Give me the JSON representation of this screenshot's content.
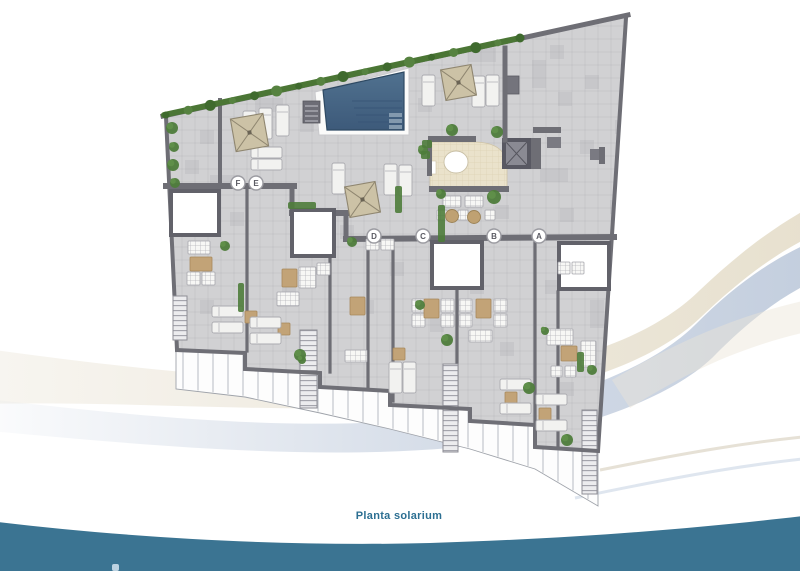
{
  "title": "Planta solarium",
  "caption": {
    "text": "Planta solarium"
  },
  "plan": {
    "type": "floorplan",
    "unit_labels": [
      "F",
      "E",
      "D",
      "C",
      "B",
      "A"
    ],
    "colors": {
      "floor": "#d1d1d3",
      "unit_floor": "#d6d5d3",
      "wall": "#6e6e75",
      "wall_dark": "#585860",
      "pool_top": "#50718f",
      "pool_bottom": "#3d5a7a",
      "pool_stripe": "#385577",
      "pool_step": "#8299ae",
      "deck_white": "#fbfbfa",
      "pergola": "#ccc2a6",
      "pergola_line": "#8f8670",
      "plant_dark": "#4e7c3b",
      "plant_light": "#5f8f49",
      "hedge": "#4b7635",
      "tan": "#c2a377",
      "lounger": "#f2f2f0",
      "lounger_edge": "#ababb0",
      "railing": "#fdfdfd",
      "railing_line": "#b8bcc2",
      "bar_floor": "#eae2cb",
      "label_ring": "#9b9ba1",
      "label_text": "#5b5b63"
    }
  },
  "background": {
    "swoosh_beige": "#eae4d6",
    "swoosh_blue": "#c7d1e0",
    "footer_wave": "#3b7492",
    "caption_color": "#2c6f92",
    "logo_mark_color": "#bcd2e1"
  }
}
